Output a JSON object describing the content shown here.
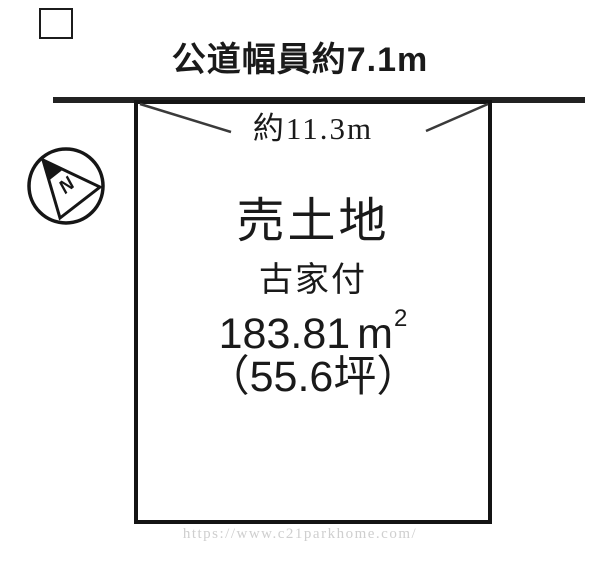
{
  "page": {
    "background": "#ffffff",
    "ink_color": "#1a1a1a",
    "road_line_color": "#222222",
    "watermark_color": "#cfcfcf"
  },
  "diagram": {
    "road_width_label": "公道幅員約7.1m",
    "frontage_label": "約11.3m",
    "compass": {
      "north_label": "N"
    },
    "plot": {
      "title": "売土地",
      "condition": "古家付",
      "area_value": "183.81",
      "area_unit_base": "m",
      "area_unit_sup": "2",
      "area_tsubo": "（55.6坪）"
    }
  },
  "watermark": {
    "url_text": "https://www.c21parkhome.com/"
  }
}
